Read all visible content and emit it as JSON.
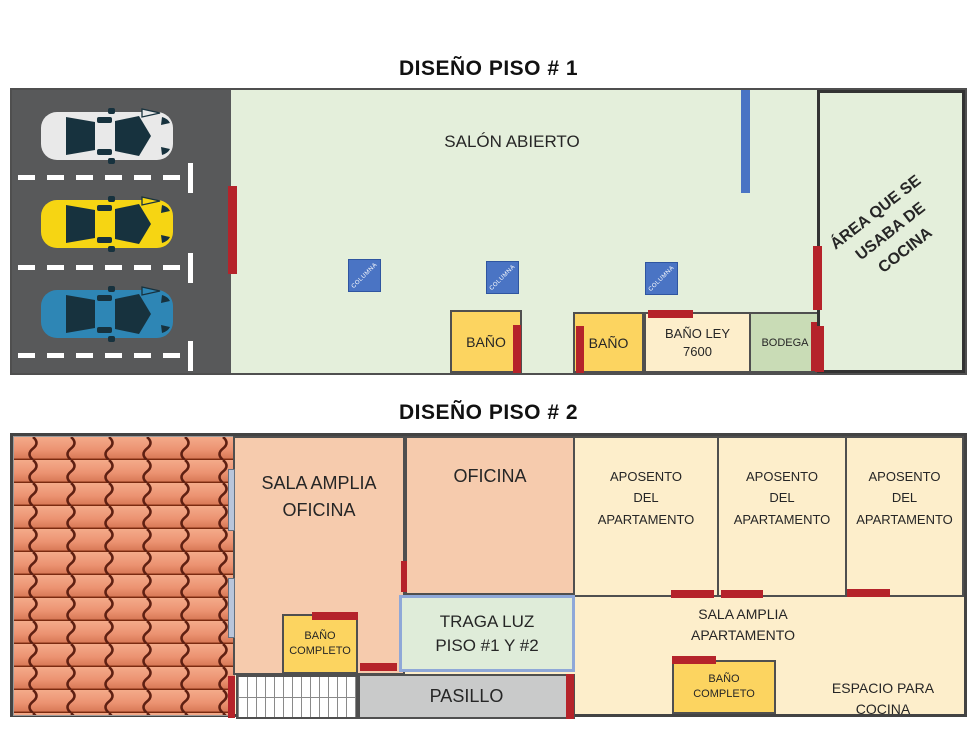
{
  "floor1": {
    "title": "DISEÑO PISO # 1",
    "salon": {
      "label": "SALÓN ABIERTO"
    },
    "columns": [
      {
        "label": "COLUMNA"
      },
      {
        "label": "COLUMNA"
      },
      {
        "label": "COLUMNA"
      }
    ],
    "rooms": {
      "bano1": {
        "label": "BAÑO"
      },
      "bano2": {
        "label": "BAÑO"
      },
      "bano_ley": {
        "label": "BAÑO LEY\n7600"
      },
      "bodega": {
        "label": "BODEGA"
      },
      "cocina": {
        "label": "ÁREA QUE SE\nUSABA DE COCINA"
      }
    },
    "parking": {
      "cars": [
        {
          "name": "white-car",
          "body": "#e9e9e9"
        },
        {
          "name": "yellow-car",
          "body": "#f6d513"
        },
        {
          "name": "blue-car",
          "body": "#2e86b5"
        }
      ],
      "background": "#58595a",
      "line_color": "#ffffff"
    }
  },
  "floor2": {
    "title": "DISEÑO PISO # 2",
    "rooms": {
      "sala_oficina": {
        "label": "SALA AMPLIA\nOFICINA"
      },
      "oficina": {
        "label": "OFICINA"
      },
      "aposentos": [
        {
          "label": "APOSENTO\nDEL\nAPARTAMENTO"
        },
        {
          "label": "APOSENTO\nDEL\nAPARTAMENTO"
        },
        {
          "label": "APOSENTO\nDEL\nAPARTAMENTO"
        }
      ],
      "traga_luz": {
        "label": "TRAGA LUZ\nPISO #1 Y #2"
      },
      "pasillo": {
        "label": "PASILLO"
      },
      "bano_oficina": {
        "label": "BAÑO\nCOMPLETO"
      },
      "sala_apartamento": {
        "label": "SALA AMPLIA\nAPARTAMENTO"
      },
      "bano_apartamento": {
        "label": "BAÑO\nCOMPLETO"
      },
      "espacio_cocina": {
        "label": "ESPACIO PARA\nCOCINA"
      }
    }
  },
  "colors": {
    "door_marker": "#b5232a",
    "column_marker": "#4a74c4",
    "wall": "#4f4f4f",
    "salon_green": "#e4efdb",
    "peach_room": "#f6cbad",
    "cream_room": "#fdeecb",
    "bath_yellow": "#fcd460",
    "bodega_green": "#c9dcb6",
    "pasillo_gray": "#c9caca",
    "traga_luz_border": "#8fa8d8",
    "roof_tile": "#ef9f7e"
  }
}
